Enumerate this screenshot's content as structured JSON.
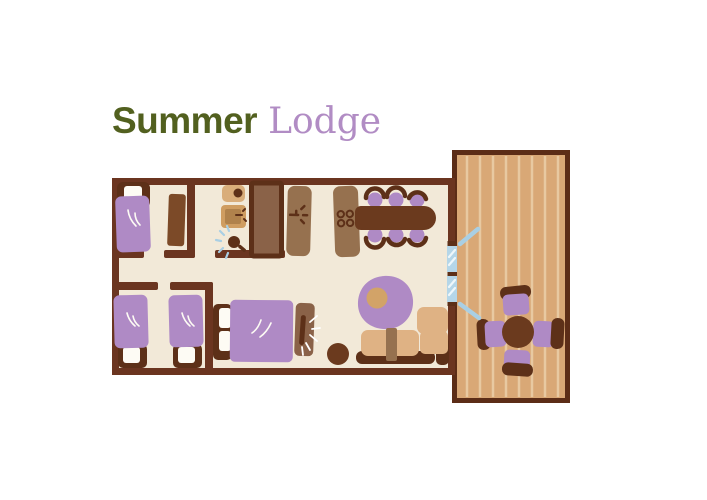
{
  "title": {
    "primary": "Summer",
    "secondary": "Lodge"
  },
  "theme": {
    "title-green": "#52601f",
    "title-purple": "#b18cc4",
    "wall": "#6b3520",
    "floor": "#f2e9d8",
    "dark-wood": "#5d3018",
    "table-wood": "#6b3a1e",
    "wardrobe-wood": "#7c4a28",
    "counter-wood": "#96714f",
    "stall-wood": "#8a6248",
    "fixture-tan": "#d9ad7a",
    "basin-tan": "#cf9d61",
    "basin-inner": "#b0824c",
    "sofa-tan": "#dfb284",
    "rug-tan": "#d2a368",
    "deck": "#d9a876",
    "deck-stripe": "#e8c9a1",
    "deck-border": "#5c2d17",
    "purple": "#af8ac5",
    "glass": "#b5d6e8",
    "glass-line": "#eef7fb",
    "spray-blue": "#a9cfe4",
    "linen-white": "#fdfbf4"
  },
  "floorplan": {
    "building": {
      "rooms": [
        {
          "name": "Bedroom 1",
          "furniture": [
            "single bed",
            "wardrobe"
          ]
        },
        {
          "name": "Bathroom",
          "furniture": [
            "toilet",
            "washbasin",
            "shower head",
            "shower cubicle"
          ]
        },
        {
          "name": "Bedroom 2",
          "furniture": [
            "single bed",
            "single bed"
          ]
        },
        {
          "name": "Kitchen / Dining",
          "furniture": [
            "sink counter",
            "stove with 4 burners",
            "dining table"
          ],
          "dining_chairs": 6
        },
        {
          "name": "Living area",
          "furniture": [
            "double bed",
            "nightstand with lamp",
            "stool",
            "rug",
            "corner sofa"
          ]
        }
      ],
      "door": {
        "type": "double glass door",
        "opens_to": "deck"
      }
    },
    "deck": {
      "name": "Deck",
      "furniture": [
        "round table"
      ],
      "chairs": 4
    }
  }
}
